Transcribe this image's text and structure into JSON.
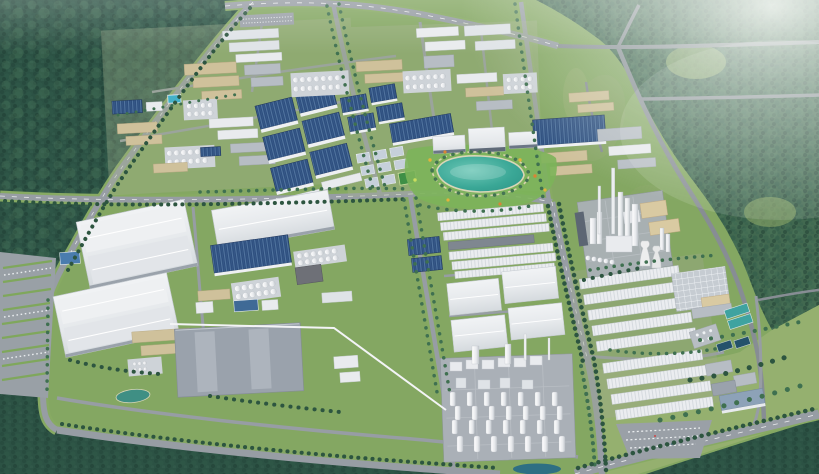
{
  "image": {
    "kind": "aerial-3d-rendering",
    "subject": "industrial-park-master-plan",
    "text_visible": "none"
  },
  "palette": {
    "forestD": "#2c5244",
    "forestM": "#3a614f",
    "forestR": "#41684f",
    "grass": "#84a762",
    "meadow": "#95b06f",
    "verge": "#87aa63",
    "garden": "#7cb45a",
    "road": "#979da4",
    "roadDk": "#878d94",
    "roadLine": "#ffffff",
    "treeD": "#2d5540",
    "treeM": "#3f7050",
    "roofW": "#e9ebee",
    "roofL": "#dfe3e7",
    "roofG": "#b7bdc4",
    "roofDG": "#9aa2ac",
    "roofB": "#2d4e7e",
    "ribB": "#51749f",
    "wall": "#eef0f2",
    "tan": "#cfc19b",
    "beige": "#d9caa2",
    "pad": "#aab0b7",
    "padL": "#ced3d8",
    "lake": "#35a191",
    "pond": "#3f8f84",
    "pondDk": "#2e6f83",
    "pool": "#44b1c8",
    "treat": "#3fa3a0",
    "treatDk": "#24526b",
    "pipe": "#f3f4f6",
    "sport": "#3f8f46"
  },
  "regions": [
    "dense-forest-northwest",
    "forest-east-with-rural-roads",
    "forest-strip-south",
    "factory-district-northwest",
    "blue-roof-warehouse-grid",
    "factory-district-north-center",
    "office-campus-with-lake",
    "chemical-plant-east",
    "large-white-warehouses-southwest",
    "flat-gray-logistics-building",
    "white-warehouse-rows-center",
    "process-plant-with-silos",
    "long-warehouse-rows-east",
    "water-treatment-basins",
    "parking-lot-west",
    "parking-lot-southeast",
    "perimeter-roads",
    "tree-lined-boulevards",
    "haze-top-right"
  ]
}
